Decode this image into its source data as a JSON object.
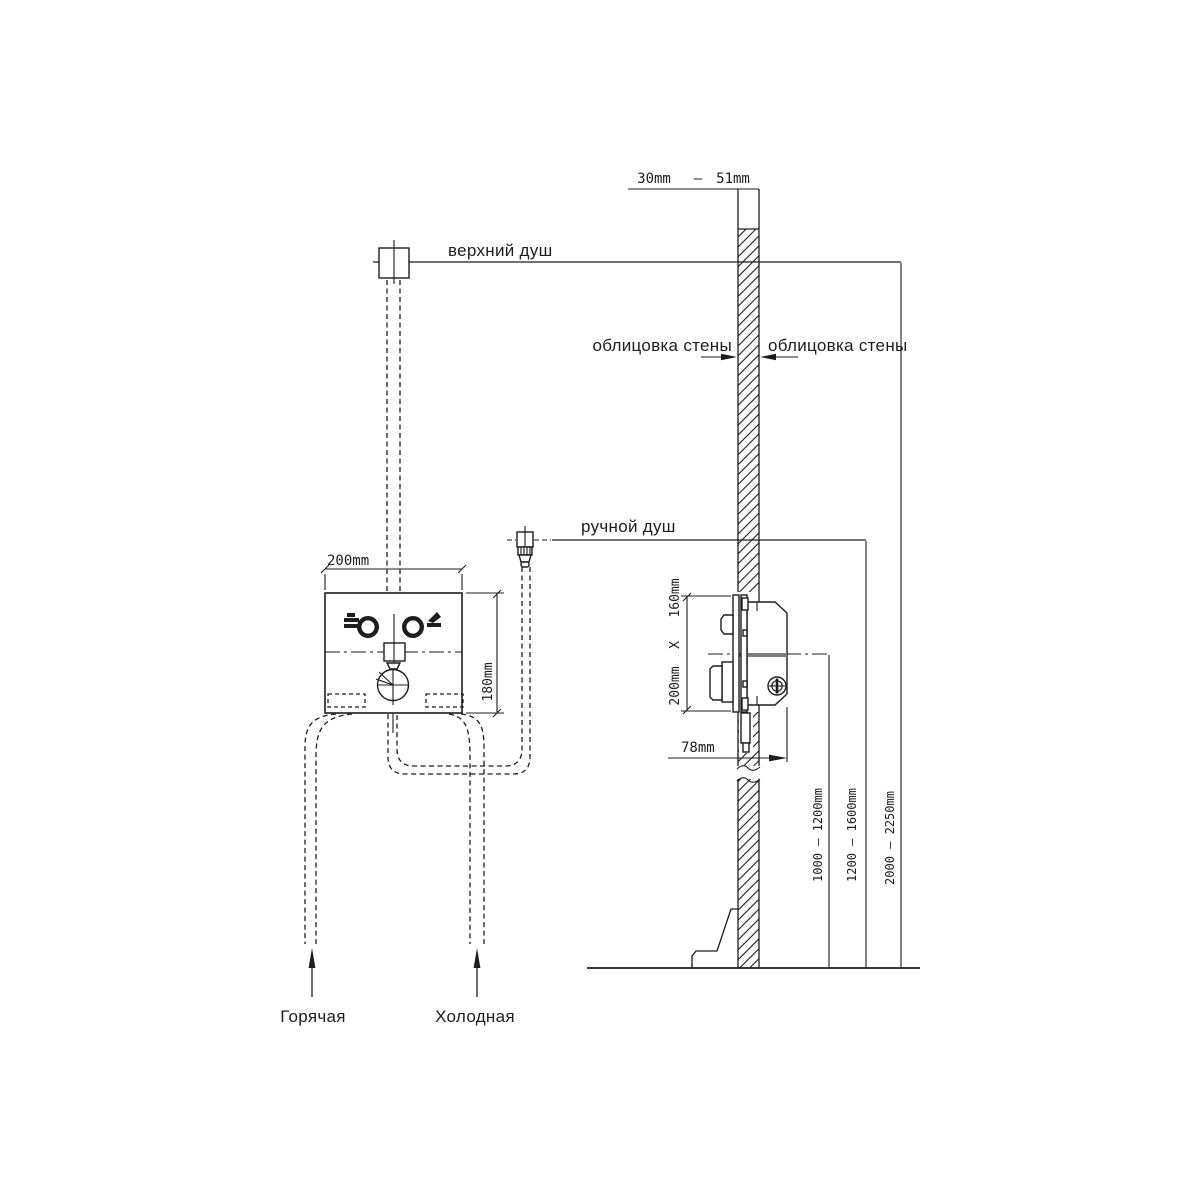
{
  "diagram": {
    "labels": {
      "top_shower": "верхний душ",
      "hand_shower": "ручной душ",
      "wall_cladding_left": "облицовка стены",
      "wall_cladding_right": "облицовка стены",
      "hot_supply": "Горячая",
      "cold_supply": "Холодная"
    },
    "dims": {
      "wall_min": "30mm",
      "wall_sep": "—",
      "wall_max": "51mm",
      "box_width": "200mm",
      "box_height": "180mm",
      "rough_in_height": "160mm",
      "rough_in_sep": "X",
      "rough_in_width": "200mm",
      "depth": "78mm",
      "mixer_height_range": "1000 — 1200mm",
      "hand_shower_height_range": "1200 — 1600mm",
      "top_shower_height_range": "2000 — 2250mm"
    },
    "colors": {
      "line": "#1d1d1d",
      "background": "#ffffff"
    }
  }
}
